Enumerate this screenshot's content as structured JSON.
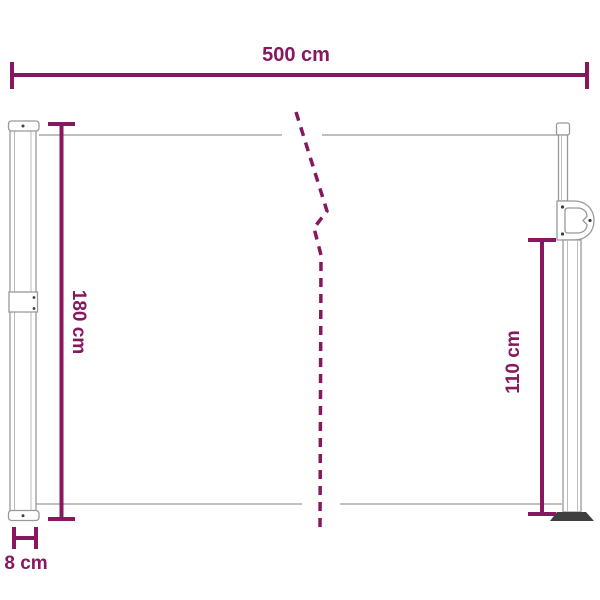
{
  "diagram": {
    "type": "product-dimension-diagram",
    "subject": "retractable side awning",
    "dimensions": {
      "width": "500 cm",
      "height_total": "180 cm",
      "height_front": "110 cm",
      "depth": "8 cm"
    },
    "colors": {
      "accent": "#87175F",
      "structure": "#999999",
      "structure_inner": "#BBBBBB",
      "foot": "#3F3F3F",
      "background": "#FFFFFF"
    }
  }
}
